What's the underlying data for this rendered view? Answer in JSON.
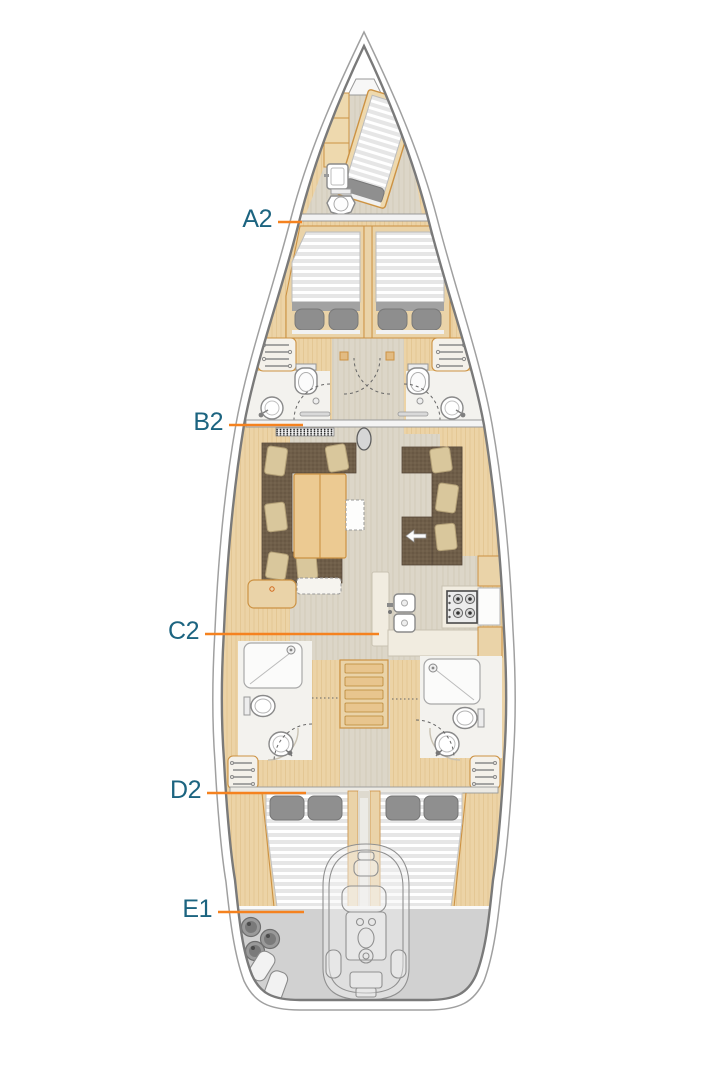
{
  "diagram": {
    "type": "yacht-deck-plan",
    "labels": [
      {
        "id": "a2",
        "text": "A2"
      },
      {
        "id": "b2",
        "text": "B2"
      },
      {
        "id": "c2",
        "text": "C2"
      },
      {
        "id": "d2",
        "text": "D2"
      },
      {
        "id": "e1",
        "text": "E1"
      }
    ],
    "colors": {
      "label_text": "#1c6480",
      "leader_line": "#f5821f",
      "hull_outline": "#7a7a7a",
      "hull_outline_outer": "#a0a0a0",
      "wood_floor": "#ecd3a6",
      "pale_floor": "#dcd6c8",
      "wood_trim": "#cc9243",
      "upholstery_brown": "#6f5e49",
      "pillow_beige": "#d9c79c",
      "mattress_gray": "#e6e6e6",
      "blanket_gray": "#8f8f8f",
      "head_floor_white": "#f3f2ee",
      "transom_deck_gray": "#d1d1d1",
      "fixture_white": "#ffffff"
    }
  }
}
